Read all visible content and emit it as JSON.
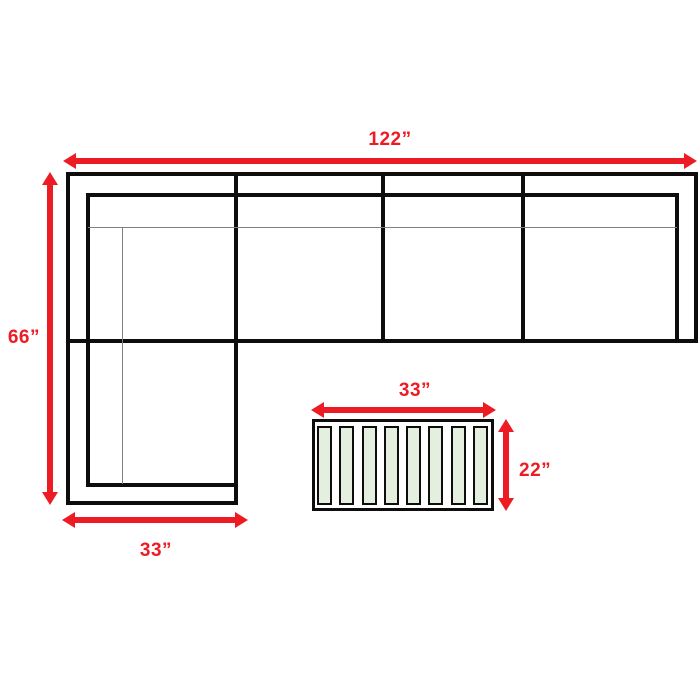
{
  "colors": {
    "arrow_red": "#ed1c24",
    "outline_black": "#0d0d0d",
    "seam_gray": "#808080",
    "slat_green": "#e5efdf",
    "background": "#ffffff"
  },
  "dimensions": {
    "sofa_total_width": "122”",
    "sofa_total_depth": "66”",
    "chaise_width": "33”",
    "table_width": "33”",
    "table_depth": "22”"
  },
  "table": {
    "slat_count": 8
  }
}
